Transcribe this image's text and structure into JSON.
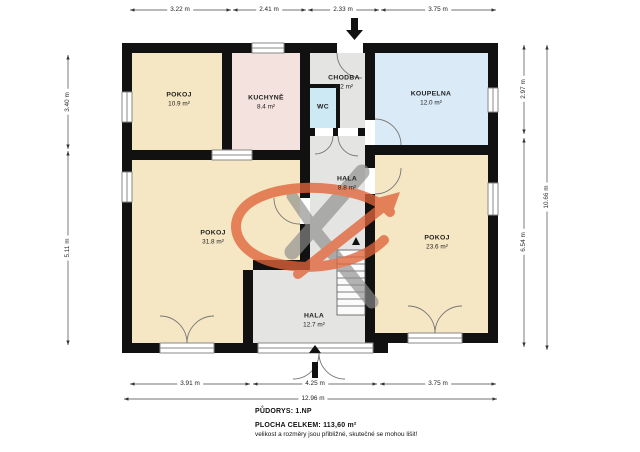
{
  "plan": {
    "rooms": {
      "pokoj_small": {
        "name": "POKOJ",
        "area": "10.9 m²"
      },
      "kuchyne": {
        "name": "KUCHYNĚ",
        "area": "8.4 m²"
      },
      "chodba": {
        "name": "CHODBA",
        "area": "4.2 m²"
      },
      "wc": {
        "name": "WC",
        "area": ""
      },
      "koupelna": {
        "name": "KOUPELNA",
        "area": "12.0 m²"
      },
      "hala_upper": {
        "name": "HALA",
        "area": "8.8 m²"
      },
      "pokoj_large": {
        "name": "POKOJ",
        "area": "31.8 m²"
      },
      "pokoj_right": {
        "name": "POKOJ",
        "area": "23.6 m²"
      },
      "hala_lower": {
        "name": "HALA",
        "area": "12.7 m²"
      }
    },
    "dimensions": {
      "top": [
        "3.22 m",
        "2.41 m",
        "2.33 m",
        "3.75 m"
      ],
      "left": [
        "3.40 m",
        "5.11 m"
      ],
      "right": [
        "2.97 m",
        "6.54 m"
      ],
      "right_total": "10.66 m",
      "bottom": [
        "3.91 m",
        "4.25 m",
        "3.75 m"
      ],
      "bottom_total": "12.96 m"
    },
    "footer": {
      "floor_label": "PŮDORYS: 1.NP",
      "area_label": "PLOCHA CELKEM:  113,60 m²",
      "disclaimer": "velikost a rozměry jsou přibližné, skutečné se mohou lišit!"
    },
    "colors": {
      "wall": "#111111",
      "room_beige": "#f6e7c4",
      "room_pink": "#f3e2dd",
      "room_gray": "#e4e4e2",
      "room_wc_blue": "#cde9f3",
      "room_bath_blue": "#daeaf6",
      "watermark_orange": "#e0643a",
      "watermark_gray": "#8e8e8e"
    }
  }
}
